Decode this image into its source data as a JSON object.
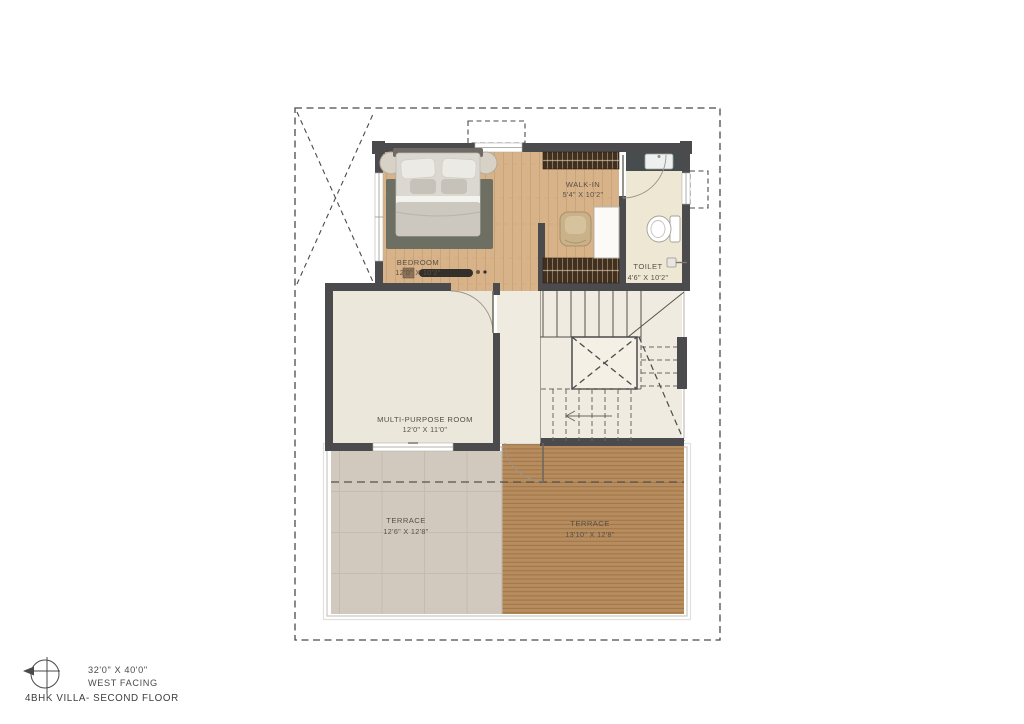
{
  "legend": {
    "plot_size": "32'0\" X 40'0\"",
    "facing": "WEST FACING",
    "title": "4BHK VILLA- SECOND FLOOR",
    "compass_icon": "compass-west-icon"
  },
  "rooms": {
    "bedroom": {
      "name": "BEDROOM",
      "size": "12'0\" X 10'2\""
    },
    "walk_in": {
      "name": "WALK-IN",
      "size": "5'4\" X 10'2\""
    },
    "toilet": {
      "name": "TOILET",
      "size": "4'6\" X 10'2\""
    },
    "multi_purpose": {
      "name": "MULTI-PURPOSE ROOM",
      "size": "12'0\" X 11'0\""
    },
    "terrace_left": {
      "name": "TERRACE",
      "size": "12'6\" X 12'8\""
    },
    "terrace_right": {
      "name": "TERRACE",
      "size": "13'10\" X 12'8\""
    }
  },
  "colors": {
    "wall": "#4b4b4d",
    "boundary": "#4a4a4a",
    "wood_floor": "#d8b289",
    "rug": "#6c6f62",
    "cream_floor": "#ece7db",
    "hall_floor": "#f0ebe0",
    "toilet_floor": "#eee7d4",
    "tile_terrace": "#d2c9be",
    "deck_terrace": "#b78c5e",
    "wardrobe": "#42301f",
    "label_text": "#554f48"
  }
}
